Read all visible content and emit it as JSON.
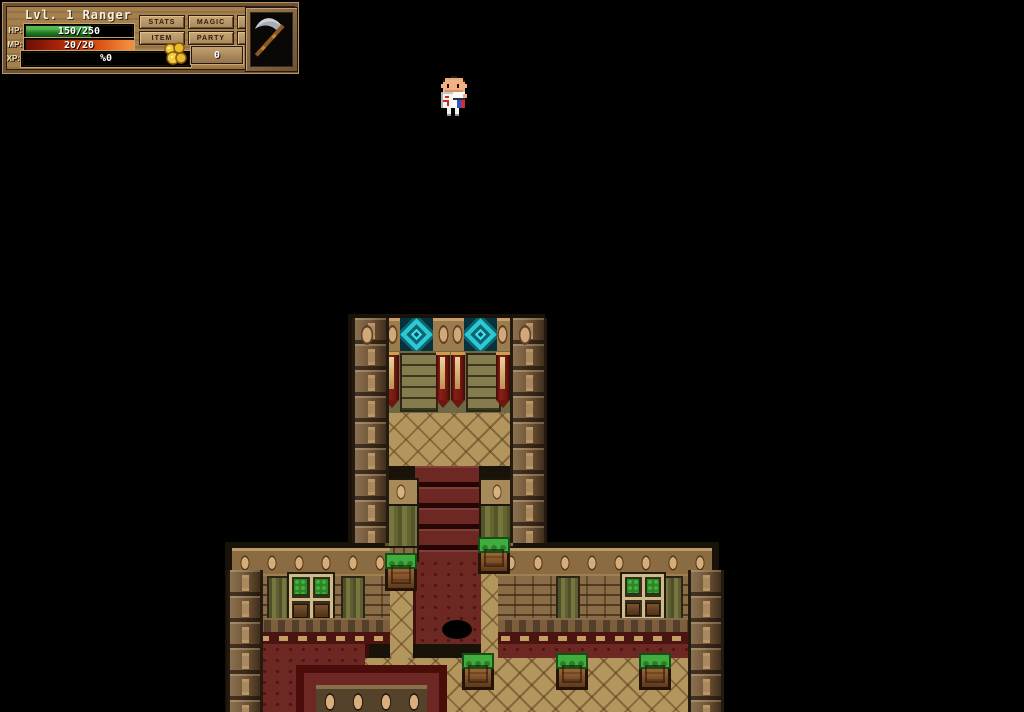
{
  "hud": {
    "title": "Lvl. 1 Ranger",
    "stats": {
      "hp": {
        "label": "HP:",
        "value": "150/250",
        "fill_style": "width:60%"
      },
      "mp": {
        "label": "MP:",
        "value": "20/20",
        "fill_style": "width:100%"
      },
      "xp": {
        "label": "XP:",
        "value": "%0",
        "fill_style": "width:0%"
      }
    },
    "menu_buttons": [
      "STATS",
      "MAGIC",
      "EQUIP",
      "ITEM",
      "PARTY",
      "HOTS"
    ],
    "gold": {
      "amount": "0",
      "icon": "gold-coins-icon"
    },
    "weapon_slot": {
      "icon": "scythe-icon"
    }
  },
  "scene": {
    "player": "ranger-hero-sprite",
    "colors": {
      "portal_cyan": "#2fd4de",
      "carpet_red": "#6e2824",
      "floor_tan": "#b3955e",
      "wood_brown": "#6b5338",
      "banner_red": "#8a1f16",
      "plant_green": "#3fae3f",
      "hud_panel": "#a5804f"
    }
  }
}
